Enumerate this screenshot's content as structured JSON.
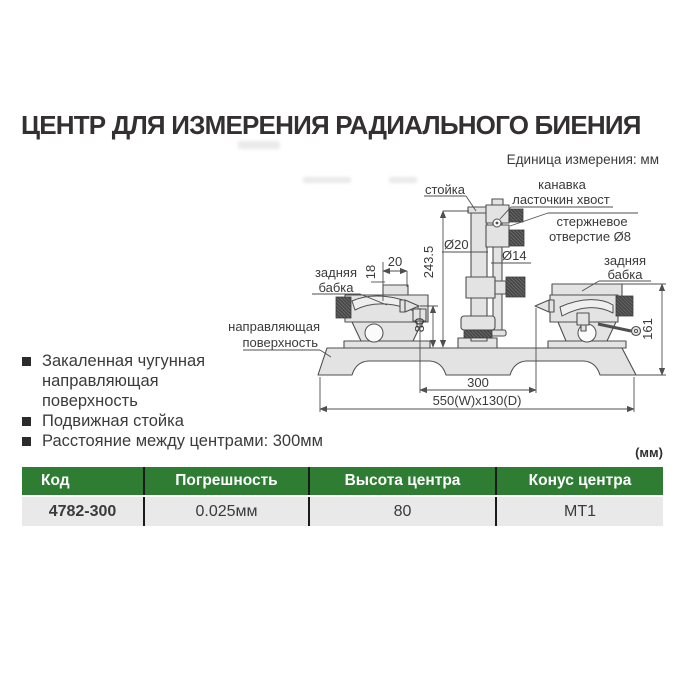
{
  "page": {
    "title": "ЦЕНТР ДЛЯ ИЗМЕРЕНИЯ РАДИАЛЬНОГО БИЕНИЯ",
    "unit_note": "Единица измерения: мм"
  },
  "diagram": {
    "labels": {
      "stand": "стойка",
      "groove_1": "канавка",
      "groove_2": "ласточкин хвост",
      "rod_hole_1": "стержневое",
      "rod_hole_2": "отверстие Ø8",
      "tailstock_1": "задняя",
      "tailstock_2": "бабка",
      "guide_1": "направляющая",
      "guide_2": "поверхность"
    },
    "dims": {
      "col_dia": "Ø20",
      "rod_dia": "Ø14",
      "col_height": "243.5",
      "center_height": "80",
      "step_h": "18",
      "step_w": "20",
      "tailstock_h": "161",
      "between_centers": "300",
      "base_size": "550(W)x130(D)"
    }
  },
  "features": [
    {
      "lines": [
        "Закаленная чугунная",
        "направляющая",
        "поверхность"
      ]
    },
    {
      "lines": [
        "Подвижная стойка"
      ]
    },
    {
      "lines": [
        "Расстояние между центрами: 300мм"
      ]
    }
  ],
  "table": {
    "unit": "(мм)",
    "headers": [
      "Код",
      "Погрешность",
      "Высота центра",
      "Конус центра"
    ],
    "rows": [
      [
        "4782-300",
        "0.025мм",
        "80",
        "МТ1"
      ]
    ]
  },
  "colors": {
    "header_green": "#2e7d33",
    "row_gray": "#e9e9e9",
    "title_color": "#343031"
  }
}
